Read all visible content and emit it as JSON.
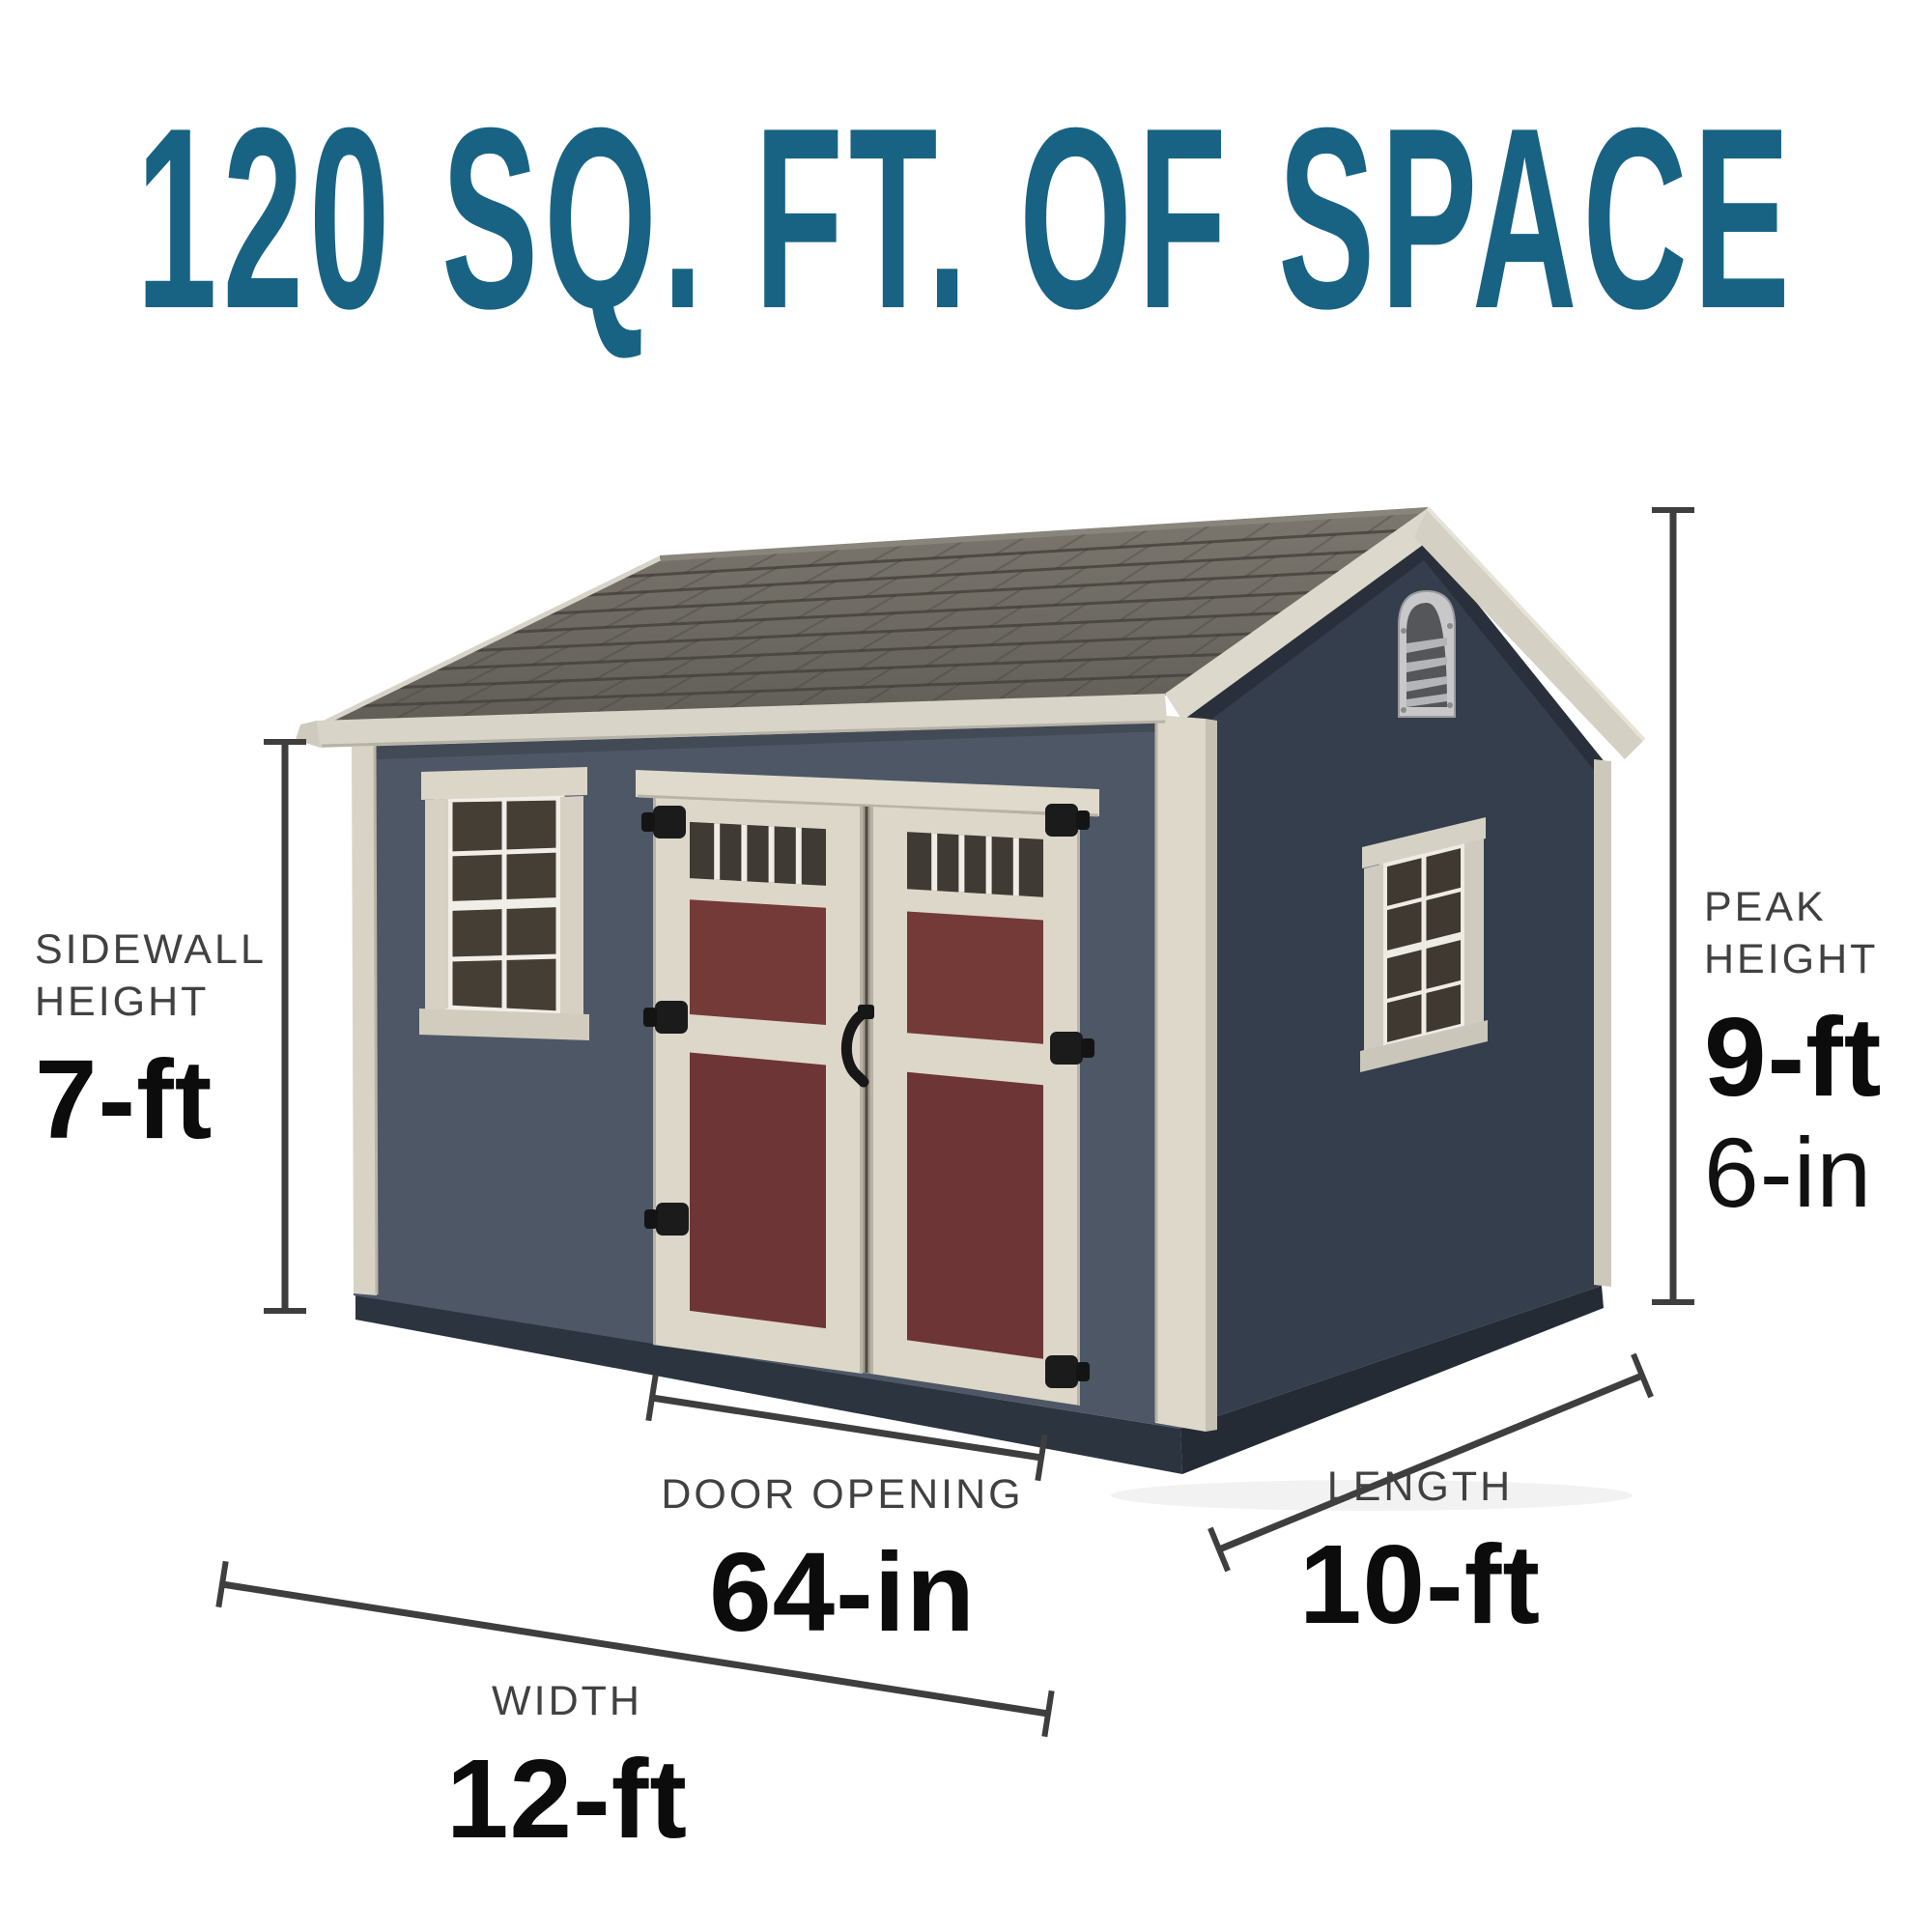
{
  "title": "120 SQ. FT. OF SPACE",
  "dimensions": {
    "sidewall_height": {
      "label": "SIDEWALL HEIGHT",
      "value": "7-ft"
    },
    "peak_height": {
      "label": "PEAK HEIGHT",
      "value_primary": "9-ft",
      "value_secondary": "6-in"
    },
    "door_opening": {
      "label": "DOOR OPENING",
      "value": "64-in"
    },
    "length": {
      "label": "LENGTH",
      "value": "10-ft"
    },
    "width": {
      "label": "WIDTH",
      "value": "12-ft"
    }
  },
  "colors": {
    "title_teal": "#186384",
    "label_gray": "#414141",
    "value_black": "#0c0c0c",
    "dimension_line": "#3e3e3e",
    "front_siding": "#4d5765",
    "side_siding": "#353e4c",
    "skirt_dark": "#2c3440",
    "trim_cream": "#ddd7ca",
    "door_panel_red": "#743a38",
    "roof_shingle_gray": "#6b6761",
    "glass_dark": "#453e35"
  }
}
